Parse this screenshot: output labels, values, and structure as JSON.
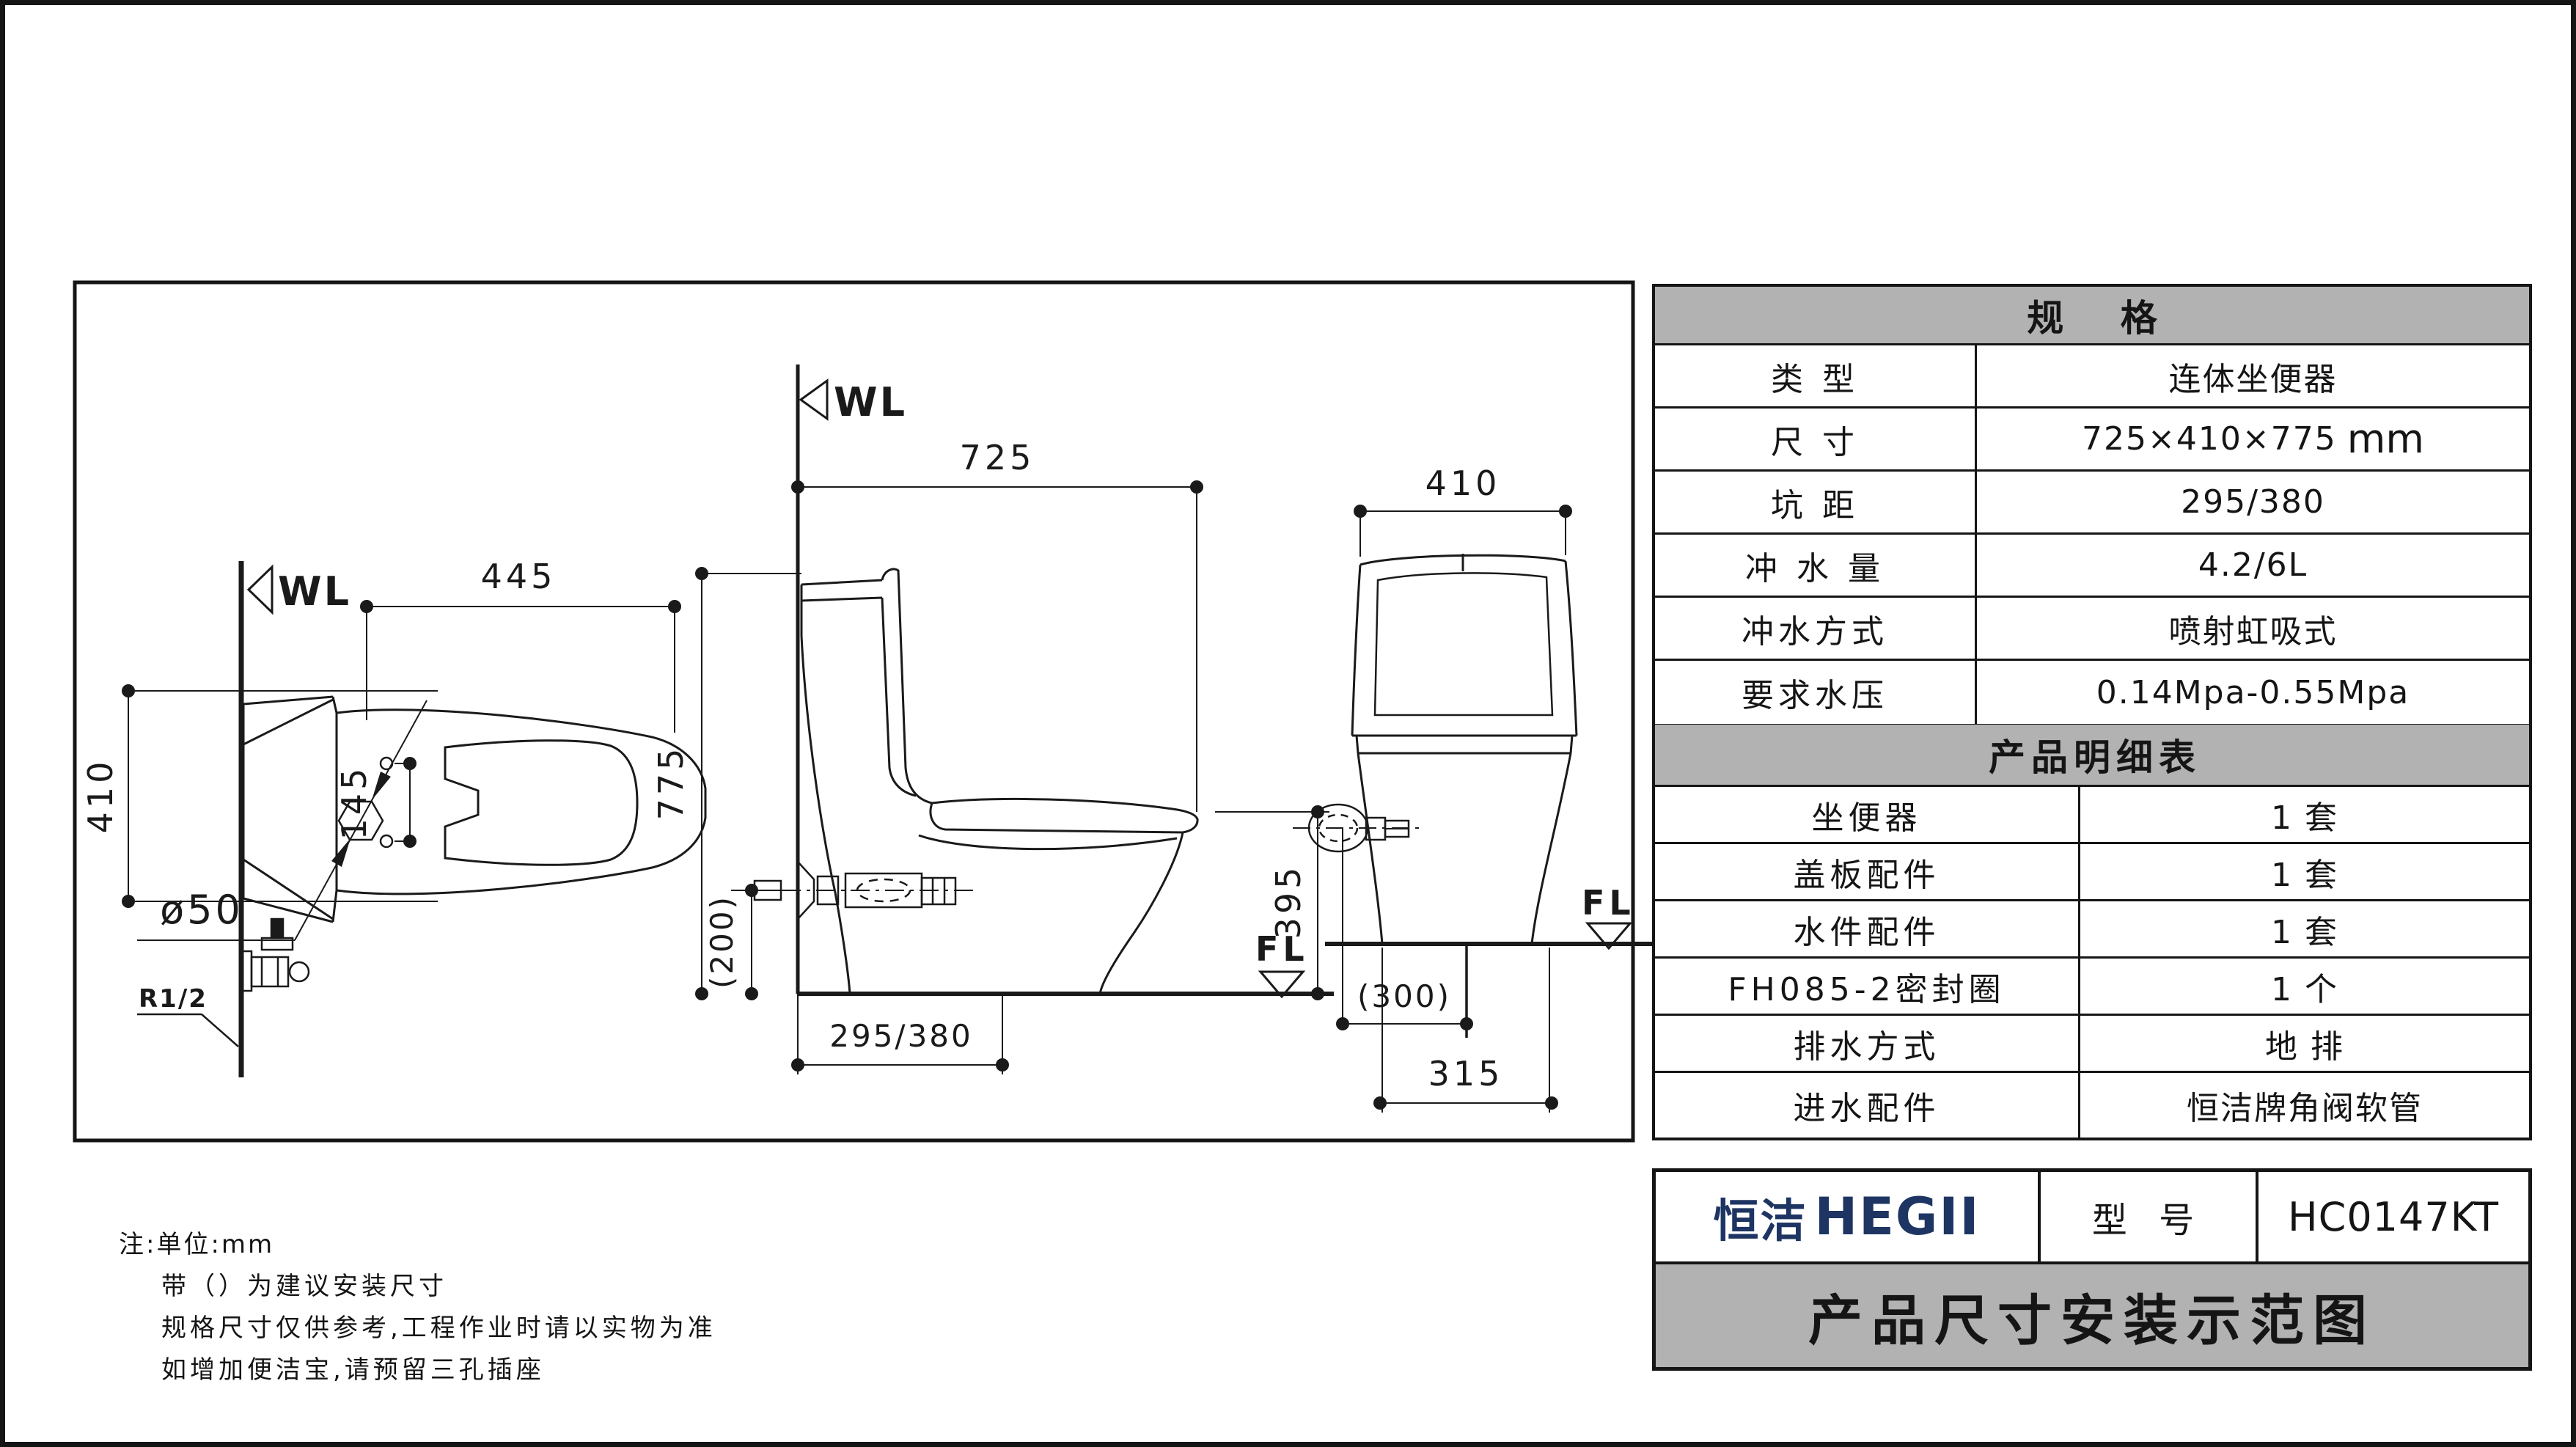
{
  "drawing": {
    "top_view": {
      "wl": "WL",
      "dim_445": "445",
      "dim_410": "410",
      "dim_d50": "ø50",
      "dim_145": "145",
      "dim_r12": "R1/2"
    },
    "side_view": {
      "wl": "WL",
      "fl": "FL",
      "dim_725": "725",
      "dim_775": "775",
      "dim_200": "(200)",
      "dim_395": "395",
      "dim_295_380": "295/380"
    },
    "front_view": {
      "fl": "FL",
      "dim_410": "410",
      "dim_300": "(300)",
      "dim_315": "315"
    }
  },
  "spec_table": {
    "title": "规  格",
    "rows": [
      {
        "label": "类  型",
        "value": "连体坐便器",
        "unit": ""
      },
      {
        "label": "尺  寸",
        "value": "725×410×775",
        "unit": "mm"
      },
      {
        "label": "坑  距",
        "value": "295/380",
        "unit": ""
      },
      {
        "label": "冲 水 量",
        "value": "4.2/6L",
        "unit": ""
      },
      {
        "label": "冲水方式",
        "value": "喷射虹吸式",
        "unit": ""
      },
      {
        "label": "要求水压",
        "value": "0.14Mpa-0.55Mpa",
        "unit": ""
      }
    ]
  },
  "detail_table": {
    "title": "产品明细表",
    "rows": [
      {
        "label": "坐便器",
        "value": "1  套"
      },
      {
        "label": "盖板配件",
        "value": "1  套"
      },
      {
        "label": "水件配件",
        "value": "1  套"
      },
      {
        "label": "FH085-2密封圈",
        "value": "1  个"
      },
      {
        "label": "排水方式",
        "value": "地 排"
      },
      {
        "label": "进水配件",
        "value": "恒洁牌角阀软管"
      }
    ]
  },
  "title_block": {
    "brand_cn": "恒洁",
    "brand_en": "HEGII",
    "brand_color": "#1e3563",
    "model_label": "型 号",
    "model_value": "HC0147KT",
    "title": "产品尺寸安装示范图"
  },
  "notes": {
    "line1": "注:单位:mm",
    "line2": "带（）为建议安装尺寸",
    "line3": "规格尺寸仅供参考,工程作业时请以实物为准",
    "line4": "如增加便洁宝,请预留三孔插座"
  },
  "colors": {
    "header_gray": "#b2b2b2",
    "line_black": "#1a1a1a",
    "brand_navy": "#1e3563"
  }
}
